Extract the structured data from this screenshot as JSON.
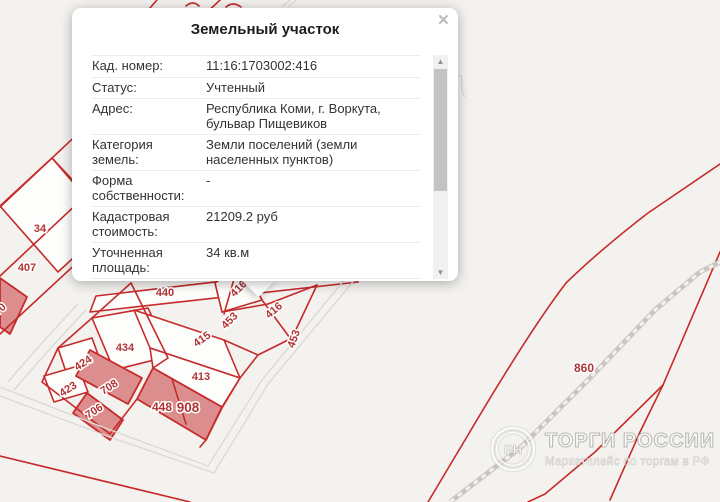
{
  "popup": {
    "title": "Земельный участок",
    "close_label": "×",
    "rows": [
      {
        "label": "Кад. номер:",
        "value": "11:16:1703002:416"
      },
      {
        "label": "Статус:",
        "value": "Учтенный"
      },
      {
        "label": "Адрес:",
        "value": "Республика Коми, г. Воркута, бульвар Пищевиков"
      },
      {
        "label": "Категория земель:",
        "value": "Земли поселений (земли населенных пунктов)"
      },
      {
        "label": "Форма собственности:",
        "value": "-"
      },
      {
        "label": "Кадастровая стоимость:",
        "value": "21209.2 руб"
      },
      {
        "label": "Уточненная площадь:",
        "value": "34 кв.м"
      },
      {
        "label": "Разрешенное",
        "value": "для размещения временного"
      }
    ],
    "scrollbar": {
      "up": "▲",
      "down": "▼"
    }
  },
  "map": {
    "colors": {
      "background": "#f4f2ef",
      "parcel_line": "#c62a2a",
      "parcel_fill": "#fdfdfb",
      "selected_fill": "#dc8e8e",
      "road": "#dcdad6",
      "railroad": "#c9c6c2",
      "label": "#b23434"
    },
    "parcel_labels": [
      {
        "text": "34",
        "x": 40,
        "y": 232,
        "rot": 0,
        "size": 11
      },
      {
        "text": "407",
        "x": 27,
        "y": 271,
        "rot": 0,
        "size": 11
      },
      {
        "text": "70",
        "x": 2,
        "y": 312,
        "rot": -40,
        "size": 11
      },
      {
        "text": "440",
        "x": 165,
        "y": 296,
        "rot": 0,
        "size": 11
      },
      {
        "text": "416",
        "x": 241,
        "y": 291,
        "rot": -45,
        "size": 11
      },
      {
        "text": "453",
        "x": 232,
        "y": 323,
        "rot": -45,
        "size": 11
      },
      {
        "text": "416",
        "x": 276,
        "y": 313,
        "rot": -40,
        "size": 11
      },
      {
        "text": "453",
        "x": 297,
        "y": 340,
        "rot": -70,
        "size": 11
      },
      {
        "text": "415",
        "x": 204,
        "y": 342,
        "rot": -35,
        "size": 11
      },
      {
        "text": "434",
        "x": 125,
        "y": 351,
        "rot": 0,
        "size": 11
      },
      {
        "text": "413",
        "x": 201,
        "y": 380,
        "rot": 0,
        "size": 11
      },
      {
        "text": "424",
        "x": 85,
        "y": 366,
        "rot": -33,
        "size": 11
      },
      {
        "text": "708",
        "x": 111,
        "y": 390,
        "rot": -33,
        "size": 11
      },
      {
        "text": "423",
        "x": 70,
        "y": 392,
        "rot": -33,
        "size": 11
      },
      {
        "text": "706",
        "x": 96,
        "y": 414,
        "rot": -33,
        "size": 11
      },
      {
        "text": "448",
        "x": 162,
        "y": 411,
        "rot": 0,
        "size": 12
      },
      {
        "text": "908",
        "x": 188,
        "y": 412,
        "rot": 0,
        "size": 13.5
      },
      {
        "text": "860",
        "x": 584,
        "y": 372,
        "rot": 0,
        "size": 12
      }
    ]
  },
  "watermark": {
    "title": "ТОРГИ РОССИИ",
    "subtitle": "Маркетплейс по торгам в РФ",
    "logo_letters": "РН"
  }
}
